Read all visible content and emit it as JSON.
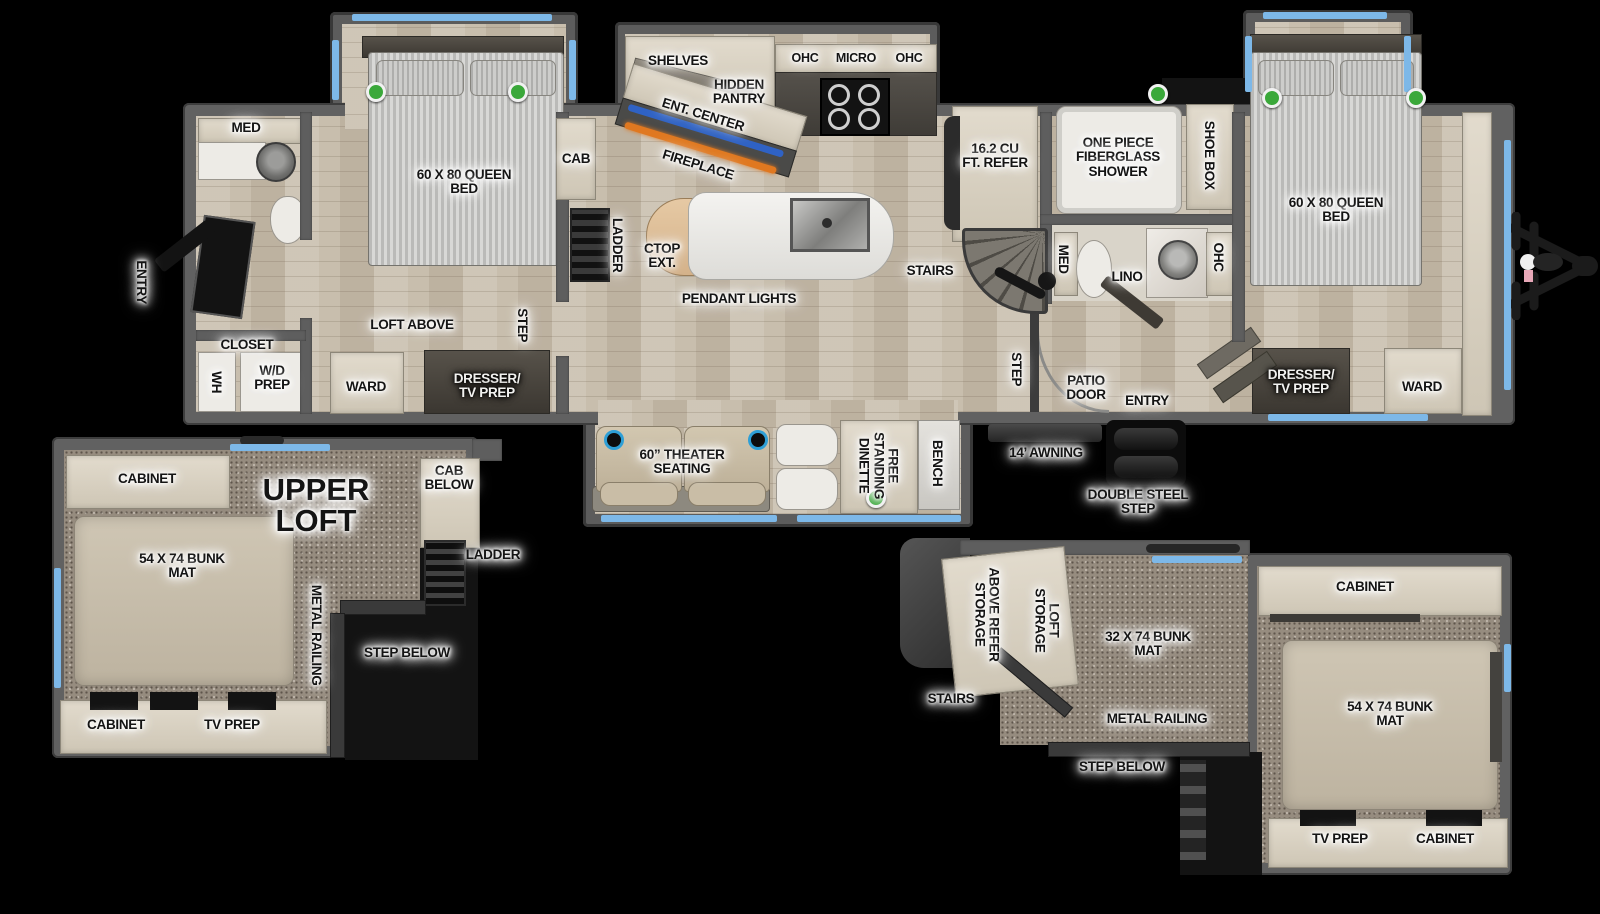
{
  "colors": {
    "background": "#000000",
    "window_accent": "#7db8e8",
    "led_green": "#3aa83a",
    "fireplace_orange": "#e07820",
    "soundbar_blue": "#2f62c4"
  },
  "main": {
    "front_bath": {
      "entry": "ENTRY",
      "med": "MED",
      "closet": "CLOSET",
      "wh": "WH",
      "wd_prep": "W/D PREP"
    },
    "bedroom_front": {
      "bed": "60 X 80 QUEEN BED",
      "loft_above": "LOFT ABOVE",
      "ward": "WARD",
      "dresser": "DRESSER/ TV PREP",
      "step": "STEP",
      "cab": "CAB"
    },
    "kitchen": {
      "ladder": "LADDER",
      "shelves": "SHELVES",
      "hidden_pantry": "HIDDEN PANTRY",
      "ent_center": "ENT. CENTER",
      "fireplace": "FIREPLACE",
      "ohc_left": "OHC",
      "micro": "MICRO",
      "ohc_right": "OHC",
      "ctop_ext": "CTOP EXT.",
      "pendant_lights": "PENDANT LIGHTS",
      "stairs": "STAIRS"
    },
    "mid_bath": {
      "refer": "16.2 CU FT. REFER",
      "shower": "ONE PIECE FIBERGLASS SHOWER",
      "shoe_box": "SHOE BOX",
      "med": "MED",
      "lino": "LINO",
      "ohc": "OHC"
    },
    "hall": {
      "step": "STEP",
      "patio_door": "PATIO DOOR",
      "entry": "ENTRY"
    },
    "bedroom_rear": {
      "bed": "60 X 80 QUEEN BED",
      "dresser": "DRESSER/ TV PREP",
      "ward": "WARD"
    },
    "living_slide": {
      "theater": "60” THEATER SEATING",
      "dinette": "FREE STANDING DINETTE",
      "bench": "BENCH"
    },
    "exterior": {
      "awning": "14’ AWNING",
      "double_step": "DOUBLE STEEL STEP"
    }
  },
  "loft_left": {
    "cabinet_top": "CABINET",
    "title": "UPPER LOFT",
    "cab_below": "CAB BELOW",
    "bunk": "54 X 74 BUNK MAT",
    "railing": "METAL RAILING",
    "ladder": "LADDER",
    "step_below": "STEP BELOW",
    "cabinet_bottom": "CABINET",
    "tv_prep": "TV PREP"
  },
  "loft_right": {
    "refer_storage": "ABOVE REFER STORAGE",
    "loft_storage": "LOFT STORAGE",
    "bunk_32": "32 X 74 BUNK MAT",
    "cabinet_top": "CABINET",
    "stairs": "STAIRS",
    "railing": "METAL RAILING",
    "step_below": "STEP BELOW",
    "bunk_54": "54 X 74 BUNK MAT",
    "tv_prep": "TV PREP",
    "cabinet_bottom": "CABINET"
  }
}
